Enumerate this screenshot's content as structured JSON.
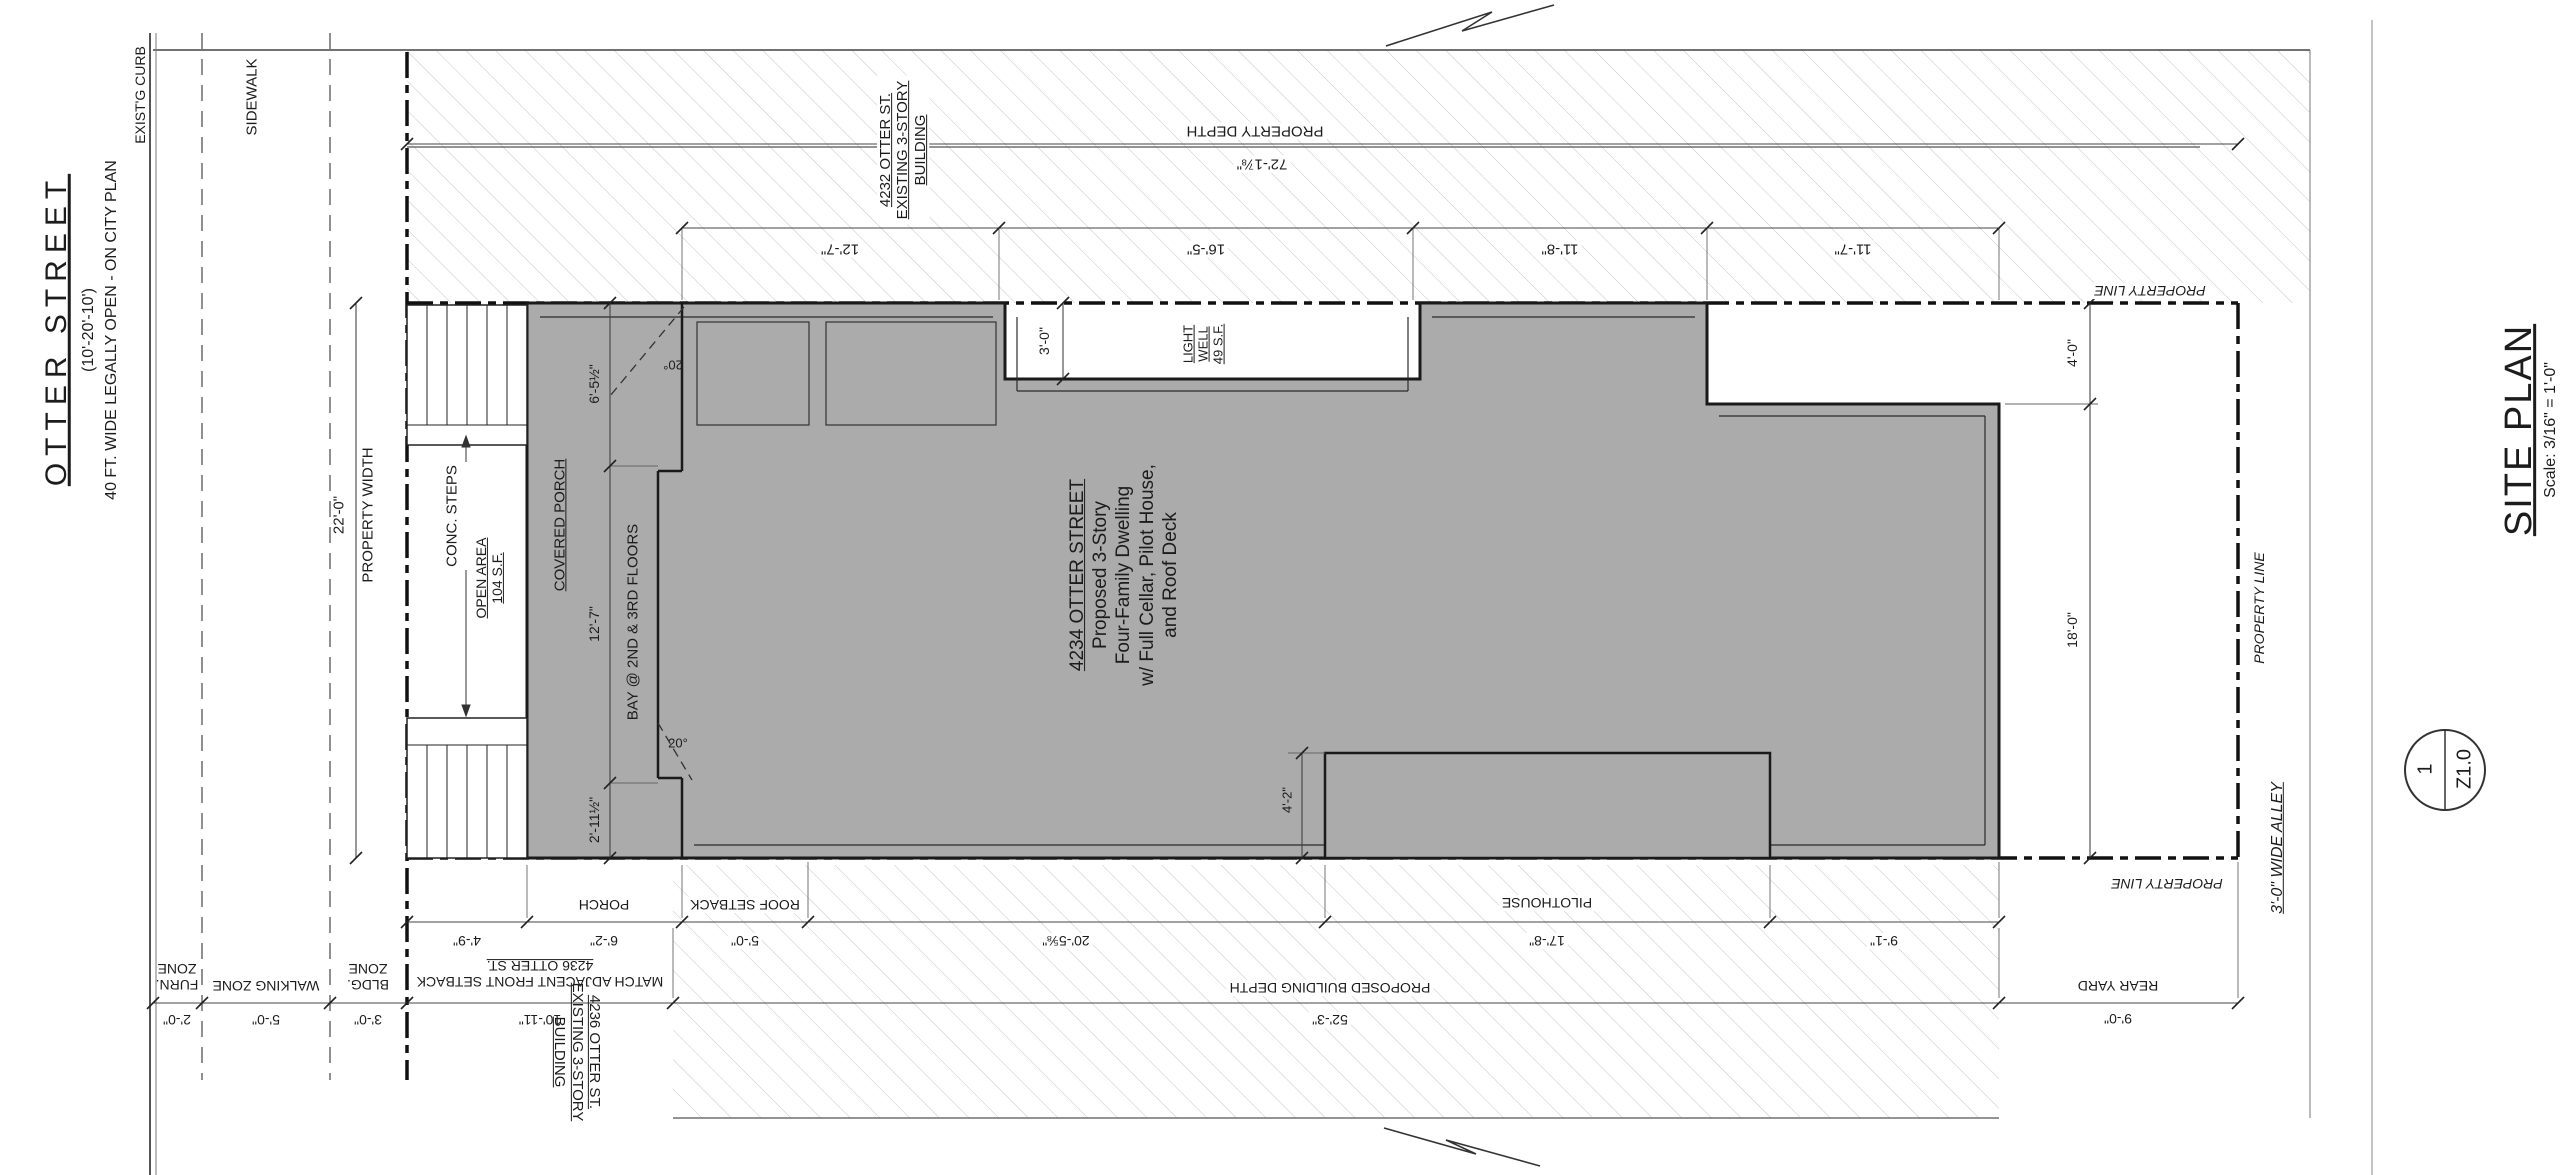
{
  "street": {
    "name": "OTTER STREET",
    "widths": "(10'-20'-10')",
    "note": "40 FT. WIDE LEGALLY OPEN - ON CITY PLAN",
    "curb": "EXIST'G CURB",
    "sidewalk": "SIDEWALK"
  },
  "zones": {
    "furn_l1": "FURN.",
    "furn_l2": "ZONE",
    "furn_dim": "2'-0\"",
    "walking": "WALKING ZONE",
    "walking_dim": "5'-0\"",
    "bldg_l1": "BLDG.",
    "bldg_l2": "ZONE",
    "bldg_dim": "3'-0\""
  },
  "property": {
    "width_label": "PROPERTY WIDTH",
    "width_dim": "22'-0\"",
    "depth_label": "PROPERTY DEPTH",
    "depth_dim": "72'-1⅞\"",
    "line_label": "PROPERTY LINE"
  },
  "neighbors": {
    "north_l1": "4232 OTTER ST.",
    "north_l2": "EXISTING 3-STORY",
    "north_l3": "BUILDING",
    "south_l1": "4236 OTTER ST.",
    "south_l2": "EXISTING 3-STORY",
    "south_l3": "BUILDING"
  },
  "top_dims": {
    "d1": "12'-7\"",
    "d2": "16'-5\"",
    "d3": "11'-8\"",
    "d4": "11'-7\""
  },
  "lightwell": {
    "dim": "3'-0\"",
    "l1": "LIGHT",
    "l2": "WELL",
    "l3": "49 S.F."
  },
  "porch": {
    "label": "COVERED PORCH",
    "d1": "6'-5½\"",
    "d2": "12'-7\"",
    "d3": "2'-11½\"",
    "bay": "BAY @ 2ND & 3RD FLOORS",
    "angle": "20°"
  },
  "steps": {
    "label": "CONC. STEPS",
    "open_l1": "OPEN AREA",
    "open_l2": "104 S.F."
  },
  "building": {
    "l1": "4234 OTTER STREET",
    "l2": "Proposed 3-Story",
    "l3": "Four-Family Dwelling",
    "l4": "w/ Full Cellar, Pilot House,",
    "l5": "and Roof Deck"
  },
  "east": {
    "d4": "4'-0\"",
    "d18": "18'-0\"",
    "rear_yard": "REAR YARD",
    "rear_dim": "9'-0\"",
    "alley": "3'-0\" WIDE ALLEY"
  },
  "bottom": {
    "porch_label": "PORCH",
    "roof_label": "ROOF SETBACK",
    "pilot_label": "PILOTHOUSE",
    "a1": "4'-9\"",
    "a2": "6'-2\"",
    "a3": "5'-0\"",
    "a4": "20'-5⅝\"",
    "a5": "17'-8\"",
    "a6": "9'-1\"",
    "match_l1": "MATCH ADJACENT FRONT SETBACK",
    "match_l2": "4236 OTTER ST.",
    "match_dim": "10'-11\"",
    "depth_label": "PROPOSED BUILDING DEPTH",
    "depth_dim": "52'-3\"",
    "ph_dim": "4'-2\""
  },
  "titleblock": {
    "number": "1",
    "sheet": "Z1.0",
    "title": "SITE PLAN",
    "scale": "Scale: 3/16\" = 1'-0\""
  },
  "colors": {
    "building_fill": "#ababab",
    "outline": "#1a1a1a",
    "hatch": "#c6c6c6"
  }
}
